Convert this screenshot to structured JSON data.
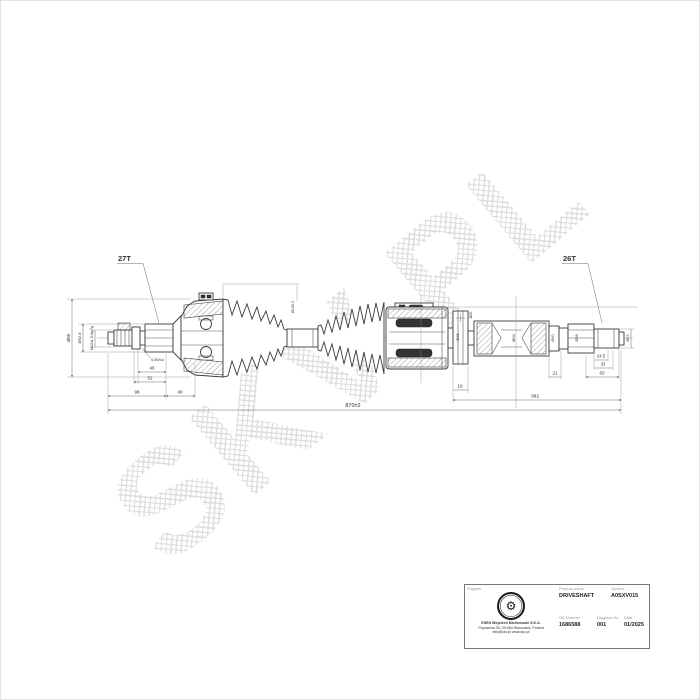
{
  "watermark": {
    "text": "SKV.PL"
  },
  "drawing": {
    "left_teeth_label": "27T",
    "right_teeth_label": "26T",
    "dims": {
      "overall_length": "870±2",
      "right_section_length": "382",
      "len48": "48",
      "len52": "52",
      "len98": "98",
      "len49": "49",
      "len19": "19",
      "len21": "21",
      "len60": "60",
      "len245": "24.5",
      "len33": "33",
      "groove": "5.3Wx2",
      "thread_spec": "M22x1.5-6g/7g",
      "dia88": "Ø88",
      "dia528": "Ø52.8",
      "dia1002": "Ø100.2",
      "dia45": "Ø45",
      "dia25": "Ø25",
      "dia64": "Ø64",
      "dia40": "Ø40",
      "dia28": "Ø28",
      "dia24": "Ø24"
    }
  },
  "title_block": {
    "supplier_label": "Supplier",
    "product_name_label": "Product name",
    "product_name": "DRIVESHAFT",
    "symbol_label": "Symbol",
    "symbol": "A0SXV015",
    "oe_number_label": "OE Number",
    "oe_number": "1686588",
    "diagram_label": "Diagram No",
    "diagram_no": "001",
    "date_label": "Date",
    "date": "01/2025",
    "company_name": "ESEN Wojciech Michnowski S.K.A.",
    "company_address": "Poprawna 25, 03-984 Warszawa, Poland",
    "company_contact": "info@skv.pl  www.skv.pl",
    "logo_icon": "⚙"
  }
}
